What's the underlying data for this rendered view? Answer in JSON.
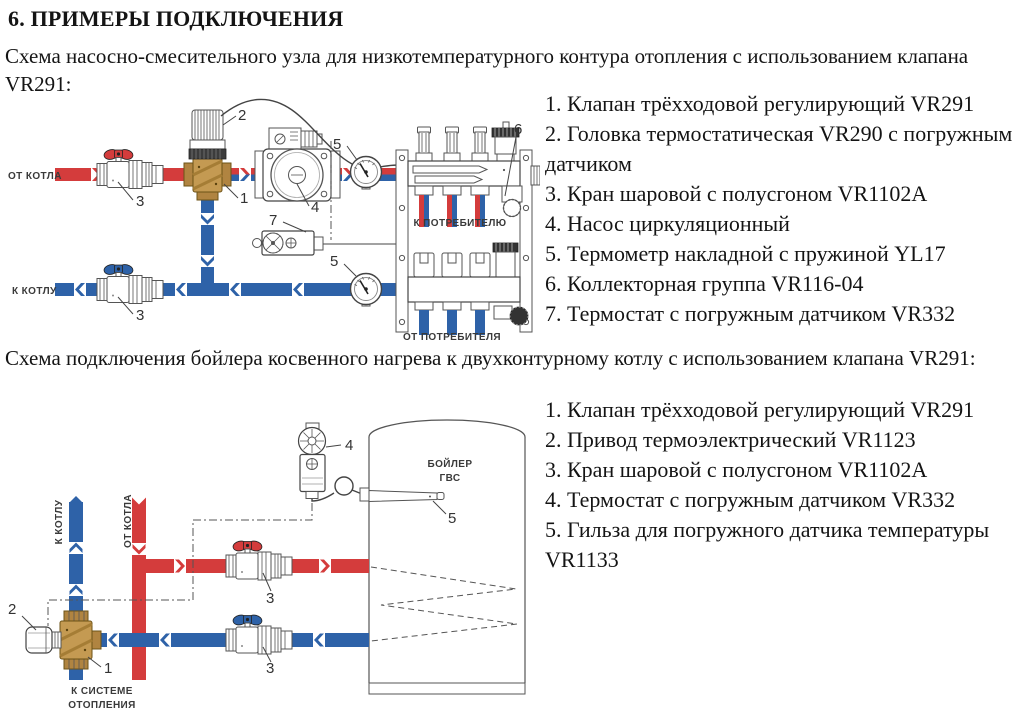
{
  "heading": "6. ПРИМЕРЫ ПОДКЛЮЧЕНИЯ",
  "intro1": "Схема насосно-смесительного узла для низкотемпературного контура отопления с использованием клапана VR291:",
  "intro2": "Схема подключения бойлера косвенного нагрева к двухконтурному котлу с использованием клапана VR291:",
  "colors": {
    "pipe_red": "#d43c3c",
    "pipe_blue": "#2e62a8",
    "brass": "#c49a52",
    "outline": "#555555",
    "body_text": "#141414",
    "diagram_label": "#3a3a3a"
  },
  "d1": {
    "labels": {
      "from_boiler": "ОТ КОТЛА",
      "to_boiler": "К КОТЛУ",
      "to_consumer": "К ПОТРЕБИТЕЛЮ",
      "from_consumer": "ОТ ПОТРЕБИТЕЛЯ"
    },
    "nums": {
      "n1": "1",
      "n2": "2",
      "n3_top": "3",
      "n3_bottom": "3",
      "n4": "4",
      "n5_top": "5",
      "n5_bottom": "5",
      "n6": "6",
      "n7": "7"
    },
    "legend": [
      "1. Клапан трёхходовой регулирующий VR291",
      "2. Головка термостатическая VR290 с погружным датчиком",
      "3. Кран шаровой с полусгоном VR1102A",
      "4. Насос циркуляционный",
      "5. Термометр накладной с пружиной YL17",
      "6. Коллекторная группа VR116-04",
      "7. Термостат с погружным датчиком VR332"
    ]
  },
  "d2": {
    "labels": {
      "to_boiler": "К КОТЛУ",
      "from_boiler": "ОТ КОТЛА",
      "to_heating": [
        "К СИСТЕМЕ",
        "ОТОПЛЕНИЯ"
      ],
      "boiler": [
        "БОЙЛЕР",
        "ГВС"
      ]
    },
    "nums": {
      "n1": "1",
      "n2": "2",
      "n3_top": "3",
      "n3_bottom": "3",
      "n4": "4",
      "n5": "5"
    },
    "legend": [
      "1. Клапан трёхходовой регулирующий VR291",
      "2. Привод термоэлектрический VR1123",
      "3. Кран шаровой с полусгоном VR1102A",
      "4. Термостат с погружным датчиком VR332",
      "5. Гильза для погружного датчика температуры VR1133"
    ]
  }
}
